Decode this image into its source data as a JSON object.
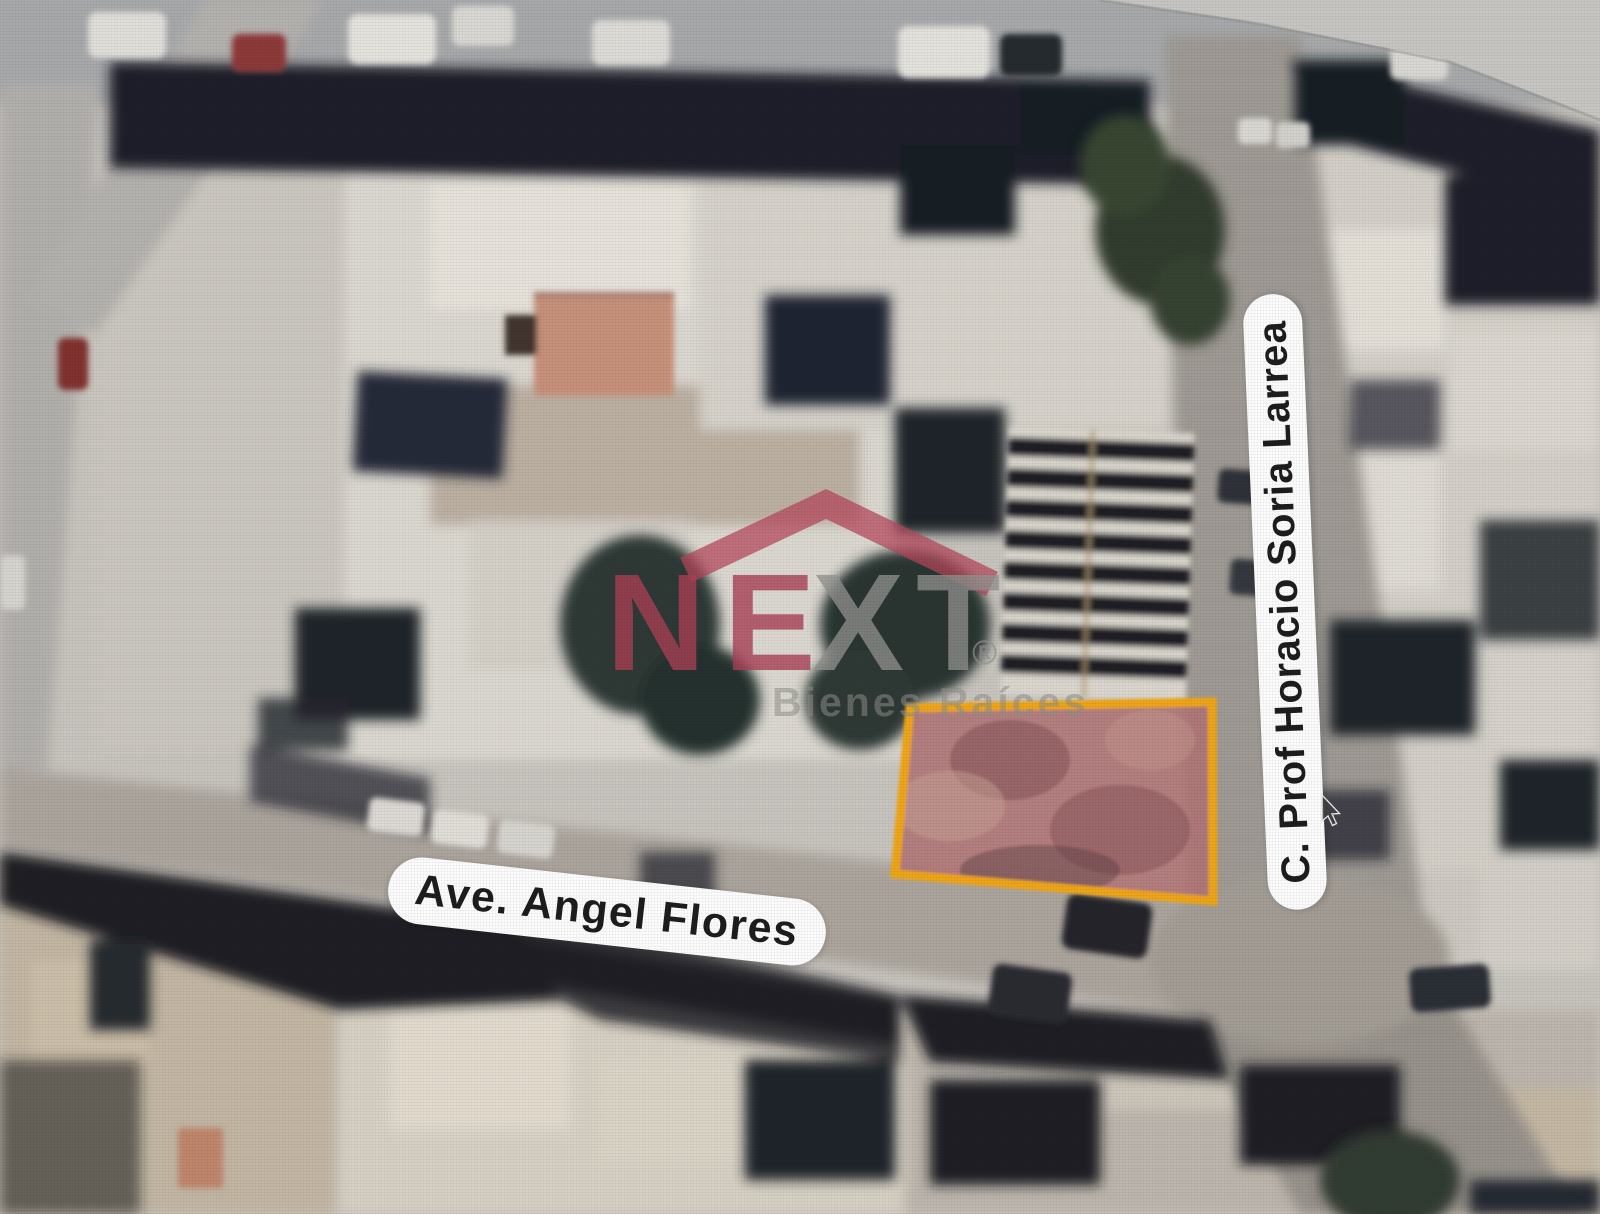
{
  "streets": {
    "horizontal": "Ave. Angel Flores",
    "vertical": "C. Prof Horacio Soria Larrea"
  },
  "watermark": {
    "brand_left": "NE",
    "brand_right": "XT",
    "registered": "®",
    "tagline": "Bienes Raíces",
    "brand_color": "#A83A50",
    "secondary_color": "#8E8E8A",
    "roof_color": "#B43E54"
  },
  "highlight": {
    "border_color": "#F2A40A",
    "fill_color": "#AF6C6E"
  },
  "cursor": "arrow-pointer"
}
